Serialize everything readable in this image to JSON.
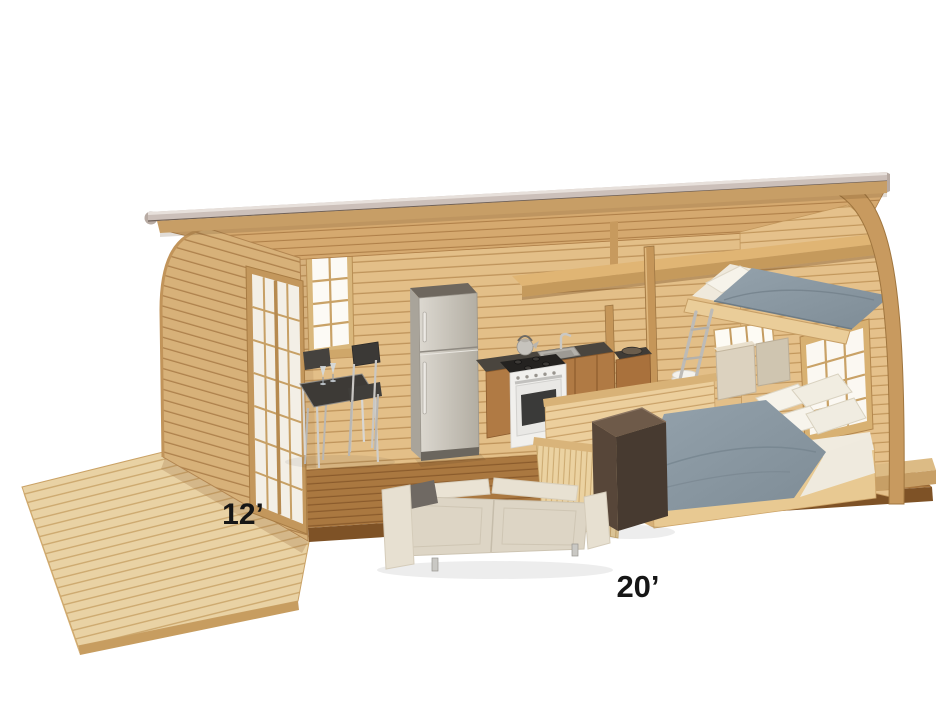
{
  "scene": {
    "type": "3d-architectural-cutaway-render",
    "subject": "Arched-roof garden pod tiny house with front deck, cut open to show the interior",
    "background_color": "#ffffff"
  },
  "labels": {
    "deck_depth": "12’",
    "cabin_length": "20’"
  },
  "rooms_and_objects": [
    "deck",
    "glazed-entry-doors",
    "back-wall-window",
    "dining-table",
    "dining-chairs",
    "wine-glasses",
    "refrigerator",
    "range-cooker",
    "kettle",
    "kitchen-sink",
    "kitchen-cabinets",
    "washbasin-unit",
    "toilet",
    "storage-cabinet",
    "loft-ladder",
    "loft-bed",
    "overhead-shelf",
    "double-bed",
    "pillows",
    "walnut-desk",
    "cream-sofa",
    "slatted-partition",
    "low-partition-wall",
    "right-wall-window",
    "arched-end-frame",
    "roof"
  ],
  "palette": {
    "background": "#ffffff",
    "deck_wood": "#e9d2a4",
    "siding_wood": "#e3bf88",
    "floor_wood": "#aa7840",
    "frame_wood": "#c89a5f",
    "roof_fascia_gray": "#ccc0ba",
    "duvet_gray_blue": "#8b99a3",
    "bedding_white": "#f3efe6",
    "sofa_cream": "#e3dccd",
    "steel_appliance": "#cdc8bf",
    "countertop_dark": "#45413b",
    "desk_walnut": "#5d4a3a",
    "window_glow": "#fbf8f2",
    "label_text": "#161616"
  }
}
